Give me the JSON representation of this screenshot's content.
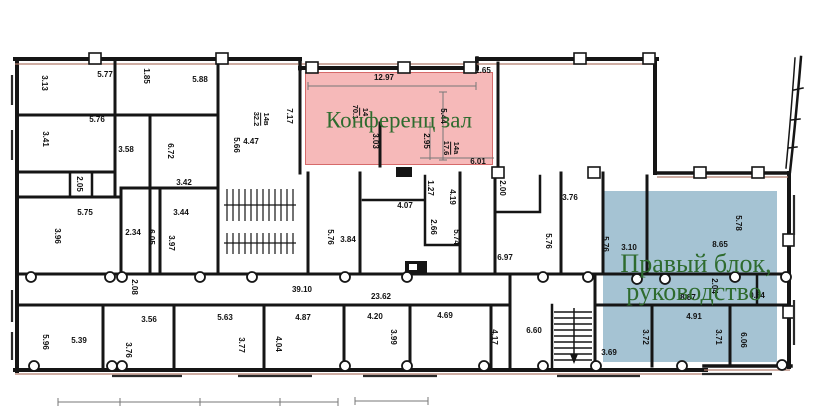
{
  "plan": {
    "conference_zone": {
      "label": "Конференц зал"
    },
    "right_block_zone": {
      "line1": "Правый блок,",
      "line2": "руководство"
    },
    "colors": {
      "conference_fill": "#f6b9b9",
      "conference_border": "#d66a6a",
      "right_block_fill": "#a5c3d3",
      "zone_text": "#2e6b2e",
      "wall": "#151515",
      "dimension_text": "#111111"
    },
    "room_tags": [
      {
        "id": "14",
        "area": "70.1",
        "x": 360,
        "y": 112
      },
      {
        "id": "14а",
        "area": "17.6",
        "x": 451,
        "y": 148
      },
      {
        "id": "14в",
        "area": "32.2",
        "x": 261,
        "y": 119
      }
    ],
    "dimensions": [
      {
        "t": "5.77",
        "x": 105,
        "y": 75
      },
      {
        "t": "3.13",
        "x": 44,
        "y": 83,
        "v": true
      },
      {
        "t": "1.85",
        "x": 146,
        "y": 76,
        "v": true
      },
      {
        "t": "5.88",
        "x": 200,
        "y": 80
      },
      {
        "t": "5.76",
        "x": 97,
        "y": 120
      },
      {
        "t": "3.41",
        "x": 45,
        "y": 139,
        "v": true
      },
      {
        "t": "3.58",
        "x": 126,
        "y": 150
      },
      {
        "t": "6.72",
        "x": 170,
        "y": 151,
        "v": true
      },
      {
        "t": "3.42",
        "x": 184,
        "y": 183
      },
      {
        "t": "2.05",
        "x": 79,
        "y": 184,
        "v": true
      },
      {
        "t": "5.75",
        "x": 85,
        "y": 213
      },
      {
        "t": "3.96",
        "x": 57,
        "y": 236,
        "v": true
      },
      {
        "t": "2.34",
        "x": 133,
        "y": 233
      },
      {
        "t": "6.05",
        "x": 151,
        "y": 237,
        "v": true
      },
      {
        "t": "3.44",
        "x": 181,
        "y": 213
      },
      {
        "t": "3.97",
        "x": 171,
        "y": 243,
        "v": true
      },
      {
        "t": "2.08",
        "x": 134,
        "y": 287,
        "v": true
      },
      {
        "t": "39.10",
        "x": 302,
        "y": 290
      },
      {
        "t": "23.62",
        "x": 381,
        "y": 297
      },
      {
        "t": "5.76",
        "x": 330,
        "y": 237,
        "v": true
      },
      {
        "t": "3.84",
        "x": 348,
        "y": 240
      },
      {
        "t": "1.27",
        "x": 430,
        "y": 188,
        "v": true
      },
      {
        "t": "4.07",
        "x": 405,
        "y": 206
      },
      {
        "t": "4.19",
        "x": 452,
        "y": 197,
        "v": true
      },
      {
        "t": "2.66",
        "x": 433,
        "y": 227,
        "v": true
      },
      {
        "t": "5.74",
        "x": 456,
        "y": 237,
        "v": true
      },
      {
        "t": "2.00",
        "x": 502,
        "y": 188,
        "v": true
      },
      {
        "t": "3.76",
        "x": 570,
        "y": 198
      },
      {
        "t": "5.76",
        "x": 548,
        "y": 241,
        "v": true
      },
      {
        "t": "6.97",
        "x": 505,
        "y": 258
      },
      {
        "t": "5.76",
        "x": 605,
        "y": 244,
        "v": true
      },
      {
        "t": "3.10",
        "x": 629,
        "y": 248
      },
      {
        "t": "8.65",
        "x": 720,
        "y": 245
      },
      {
        "t": "5.78",
        "x": 738,
        "y": 223,
        "v": true
      },
      {
        "t": "12.97",
        "x": 384,
        "y": 78
      },
      {
        "t": "1.65",
        "x": 483,
        "y": 71
      },
      {
        "t": "7.17",
        "x": 289,
        "y": 116,
        "v": true
      },
      {
        "t": "4.47",
        "x": 251,
        "y": 142
      },
      {
        "t": "5.66",
        "x": 236,
        "y": 145,
        "v": true
      },
      {
        "t": "5.44",
        "x": 443,
        "y": 116,
        "v": true
      },
      {
        "t": "3.03",
        "x": 375,
        "y": 141,
        "v": true
      },
      {
        "t": "2.95",
        "x": 426,
        "y": 141,
        "v": true
      },
      {
        "t": "6.01",
        "x": 478,
        "y": 162
      },
      {
        "t": "2.04",
        "x": 714,
        "y": 286,
        "v": true
      },
      {
        "t": "8.87",
        "x": 688,
        "y": 298
      },
      {
        "t": "0.54",
        "x": 757,
        "y": 296
      },
      {
        "t": "4.91",
        "x": 694,
        "y": 317
      },
      {
        "t": "3.72",
        "x": 645,
        "y": 337,
        "v": true
      },
      {
        "t": "3.71",
        "x": 718,
        "y": 337,
        "v": true
      },
      {
        "t": "6.06",
        "x": 743,
        "y": 340,
        "v": true
      },
      {
        "t": "3.69",
        "x": 609,
        "y": 353
      },
      {
        "t": "6.60",
        "x": 534,
        "y": 331
      },
      {
        "t": "3.56",
        "x": 149,
        "y": 320
      },
      {
        "t": "3.76",
        "x": 128,
        "y": 350,
        "v": true
      },
      {
        "t": "5.63",
        "x": 225,
        "y": 318
      },
      {
        "t": "3.77",
        "x": 241,
        "y": 345,
        "v": true
      },
      {
        "t": "4.87",
        "x": 303,
        "y": 318
      },
      {
        "t": "4.04",
        "x": 278,
        "y": 344,
        "v": true
      },
      {
        "t": "4.20",
        "x": 375,
        "y": 317
      },
      {
        "t": "3.99",
        "x": 393,
        "y": 337,
        "v": true
      },
      {
        "t": "4.69",
        "x": 445,
        "y": 316
      },
      {
        "t": "4.17",
        "x": 494,
        "y": 337,
        "v": true
      },
      {
        "t": "5.39",
        "x": 79,
        "y": 341
      },
      {
        "t": "5.96",
        "x": 45,
        "y": 342,
        "v": true
      }
    ]
  }
}
